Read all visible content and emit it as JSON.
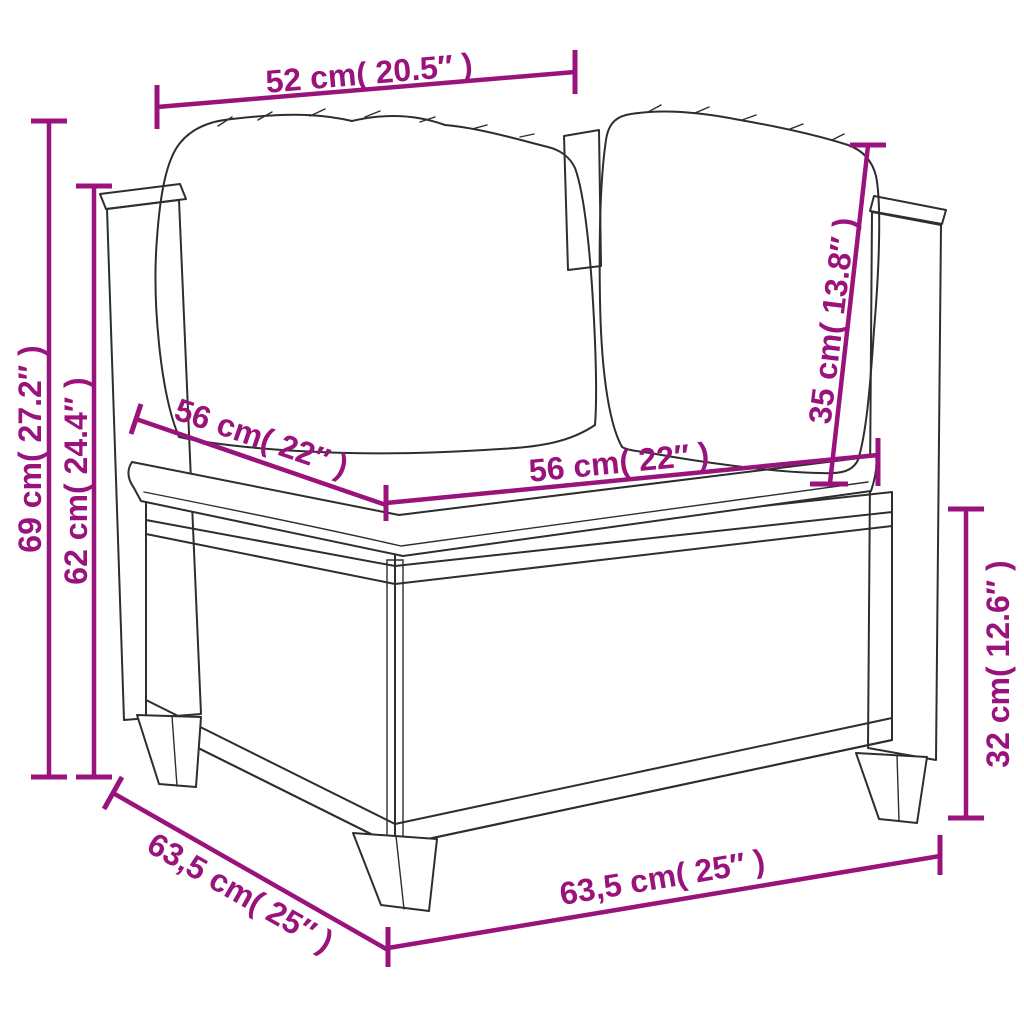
{
  "colors": {
    "accent": "#9A137C",
    "outline": "#2e2e2e",
    "background": "#ffffff"
  },
  "dimensions": {
    "top_width": {
      "label": "52 cm( 20.5″ )"
    },
    "total_height": {
      "label": "69 cm( 27.2″ )"
    },
    "arm_height": {
      "label": "62 cm( 24.4″ )"
    },
    "seat_depth": {
      "label": "56 cm( 22″ )"
    },
    "seat_width": {
      "label": "56 cm( 22″ )"
    },
    "back_cushion_height": {
      "label": "35 cm( 13.8″ )"
    },
    "base_height": {
      "label": "32 cm( 12.6″ )"
    },
    "base_depth": {
      "label": "63,5 cm( 25″ )"
    },
    "base_width": {
      "label": "63,5 cm( 25″ )"
    }
  }
}
